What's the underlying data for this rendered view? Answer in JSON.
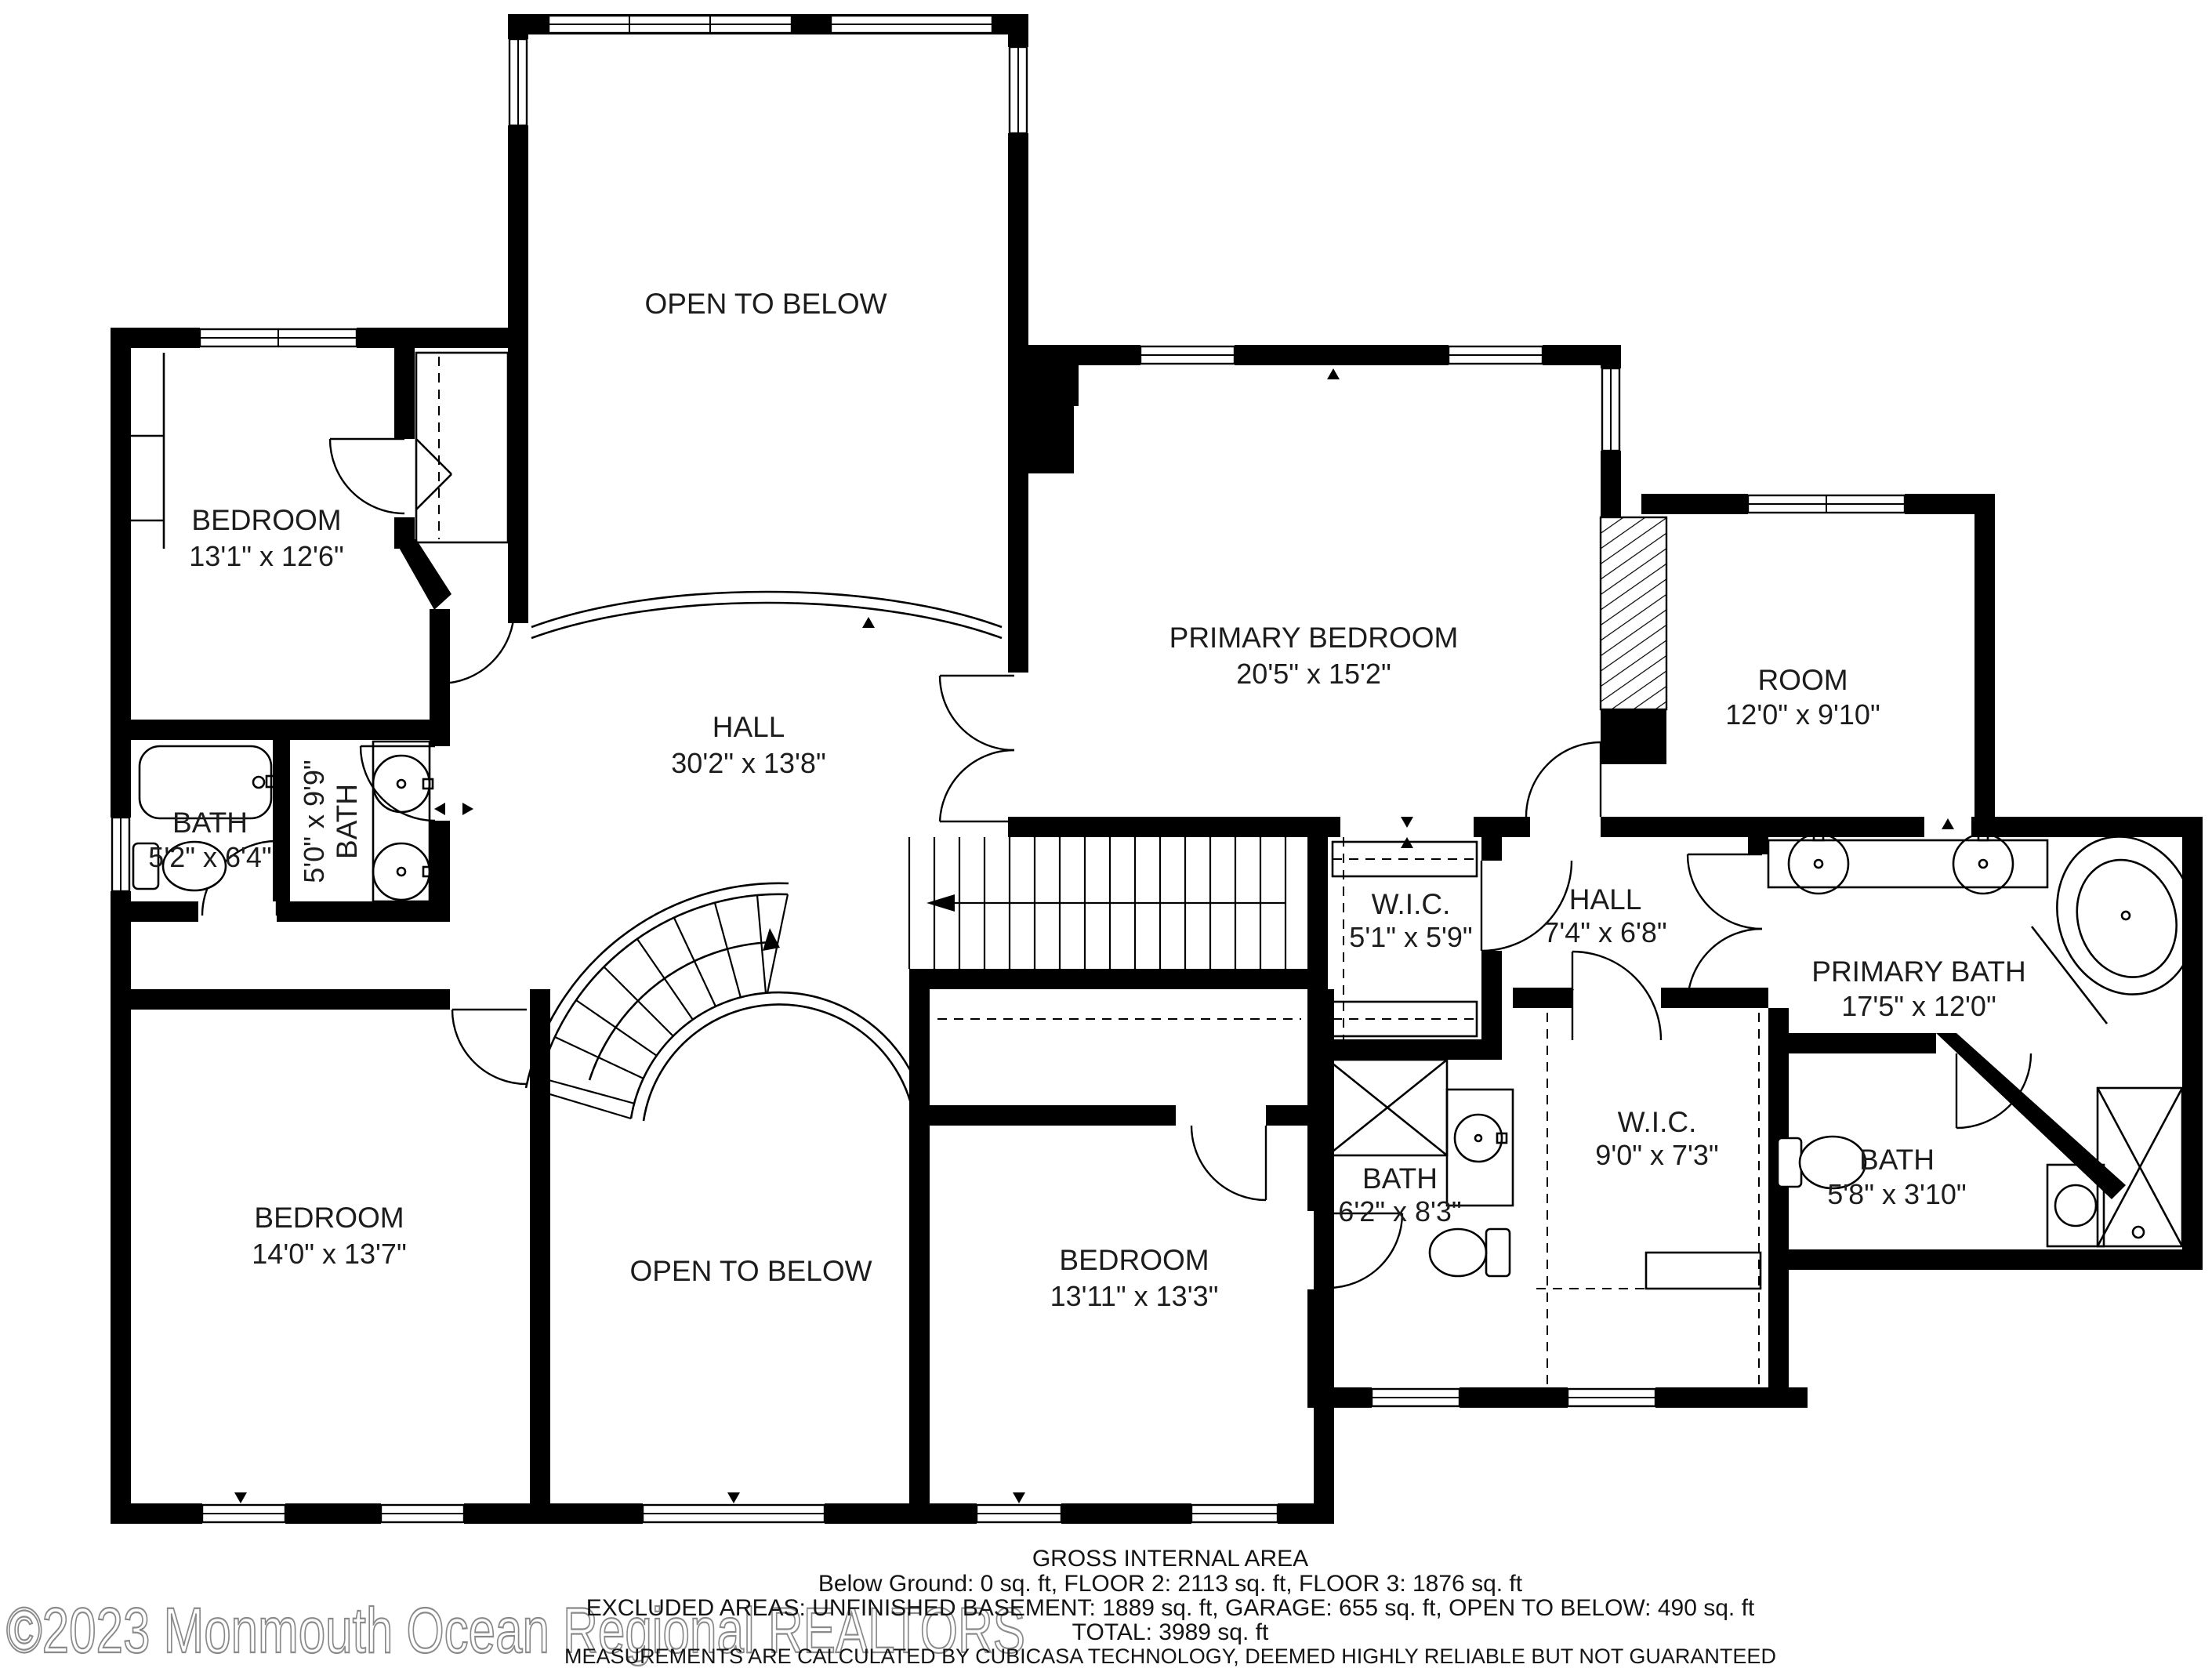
{
  "rooms": {
    "open_below_top": {
      "name": "OPEN TO BELOW"
    },
    "bedroom_tl": {
      "name": "BEDROOM",
      "dims": "13'1\" x 12'6\""
    },
    "hall_main": {
      "name": "HALL",
      "dims": "30'2\" x 13'8\""
    },
    "primary_bedroom": {
      "name": "PRIMARY BEDROOM",
      "dims": "20'5\" x 15'2\""
    },
    "room_right": {
      "name": "ROOM",
      "dims": "12'0\" x 9'10\""
    },
    "bath_1": {
      "name": "BATH",
      "dims": "5'2\" x 6'4\""
    },
    "bath_2": {
      "name": "BATH",
      "dims": "5'0\" x 9'9\""
    },
    "bedroom_bl": {
      "name": "BEDROOM",
      "dims": "14'0\" x 13'7\""
    },
    "open_below_bottom": {
      "name": "OPEN TO BELOW"
    },
    "bedroom_bm": {
      "name": "BEDROOM",
      "dims": "13'11\" x 13'3\""
    },
    "wic_small": {
      "name": "W.I.C.",
      "dims": "5'1\" x 5'9\""
    },
    "hall_small": {
      "name": "HALL",
      "dims": "7'4\" x 6'8\""
    },
    "primary_bath": {
      "name": "PRIMARY BATH",
      "dims": "17'5\" x 12'0\""
    },
    "bath_3": {
      "name": "BATH",
      "dims": "6'2\" x 8'3\""
    },
    "wic_large": {
      "name": "W.I.C.",
      "dims": "9'0\" x 7'3\""
    },
    "bath_4": {
      "name": "BATH",
      "dims": "5'8\" x 3'10\""
    }
  },
  "footer": {
    "line1": "GROSS INTERNAL AREA",
    "line2": "Below Ground: 0 sq. ft, FLOOR 2: 2113 sq. ft, FLOOR 3: 1876 sq. ft",
    "line3": "EXCLUDED AREAS: UNFINISHED BASEMENT: 1889 sq. ft, GARAGE: 655 sq. ft, OPEN TO BELOW: 490 sq. ft",
    "line4": "TOTAL: 3989 sq. ft",
    "line5": "MEASUREMENTS ARE CALCULATED BY CUBICASA TECHNOLOGY, DEEMED HIGHLY RELIABLE BUT NOT GUARANTEED"
  },
  "watermark": "©2023 Monmouth Ocean Regional REALTORS",
  "colors": {
    "wall": "#000000",
    "background": "#ffffff",
    "text": "#1c1c1c",
    "watermark_stroke": "#8a8a8a"
  }
}
